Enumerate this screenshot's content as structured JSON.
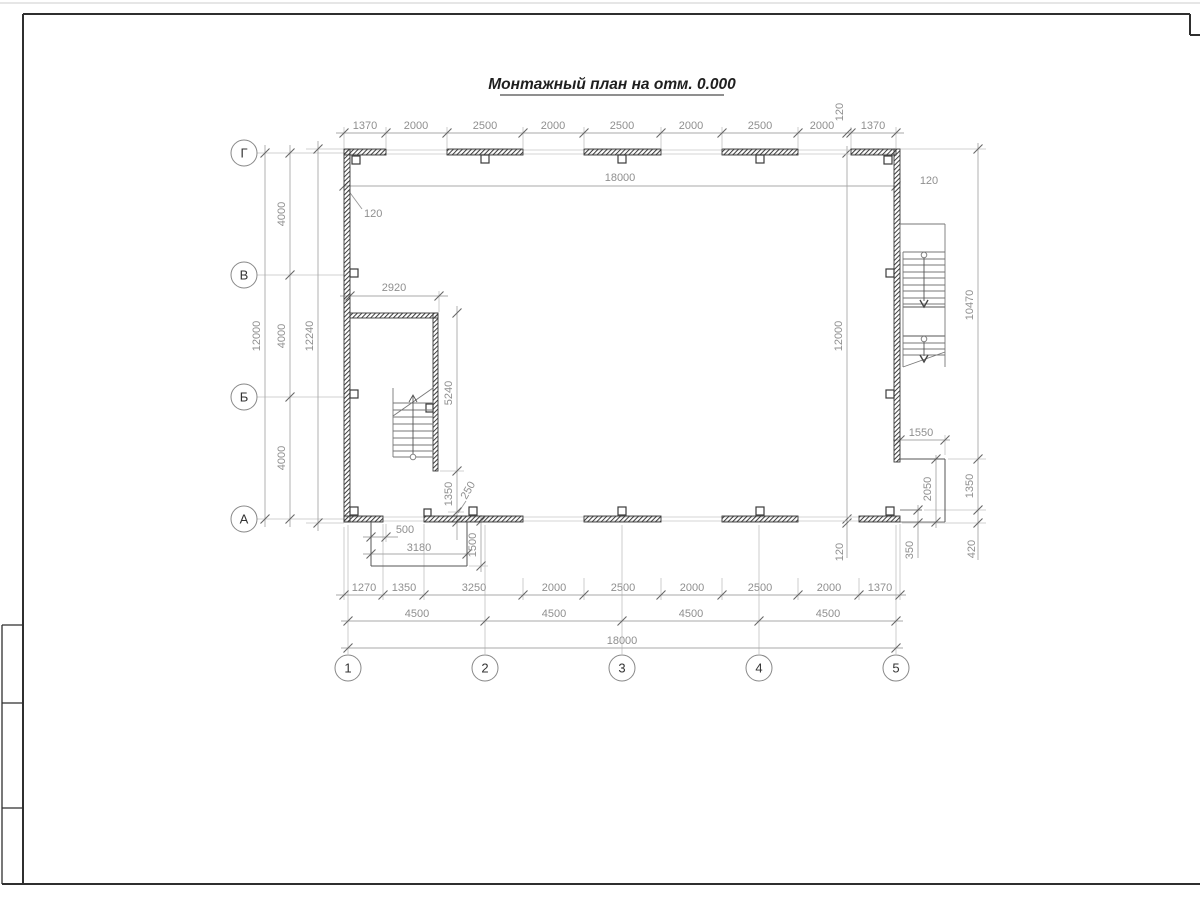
{
  "title": "Монтажный план на отм. 0.000",
  "axes": {
    "rows": [
      "Г",
      "В",
      "Б",
      "А"
    ],
    "cols": [
      "1",
      "2",
      "3",
      "4",
      "5"
    ]
  },
  "dims": {
    "top_chain": [
      "1370",
      "2000",
      "2500",
      "2000",
      "2500",
      "2000",
      "2500",
      "2000",
      "120",
      "1370"
    ],
    "top_overall": "18000",
    "wall_leader": "120",
    "right_top_offset": "120",
    "left": {
      "spans": [
        "4000",
        "4000",
        "4000"
      ],
      "axis_total": "12000",
      "overall": "12240"
    },
    "right": {
      "axis_total": "12000",
      "bottom_offset": "120",
      "chain": [
        "10470",
        "1350",
        "420"
      ]
    },
    "stair_left": {
      "width": "2920",
      "length": "5240",
      "to_wall": "1350",
      "gap": "250"
    },
    "porch_left": {
      "door": "500",
      "width": "3180",
      "depth": "1500"
    },
    "porch_right": {
      "width": "1550",
      "depth": "2050",
      "offset": "350",
      "edge": "420"
    },
    "bottom_chain": [
      "1270",
      "1350",
      "3250",
      "2000",
      "2500",
      "2000",
      "2500",
      "2000",
      "1370"
    ],
    "bottom_spans": [
      "4500",
      "4500",
      "4500",
      "4500"
    ],
    "bottom_overall": "18000"
  }
}
